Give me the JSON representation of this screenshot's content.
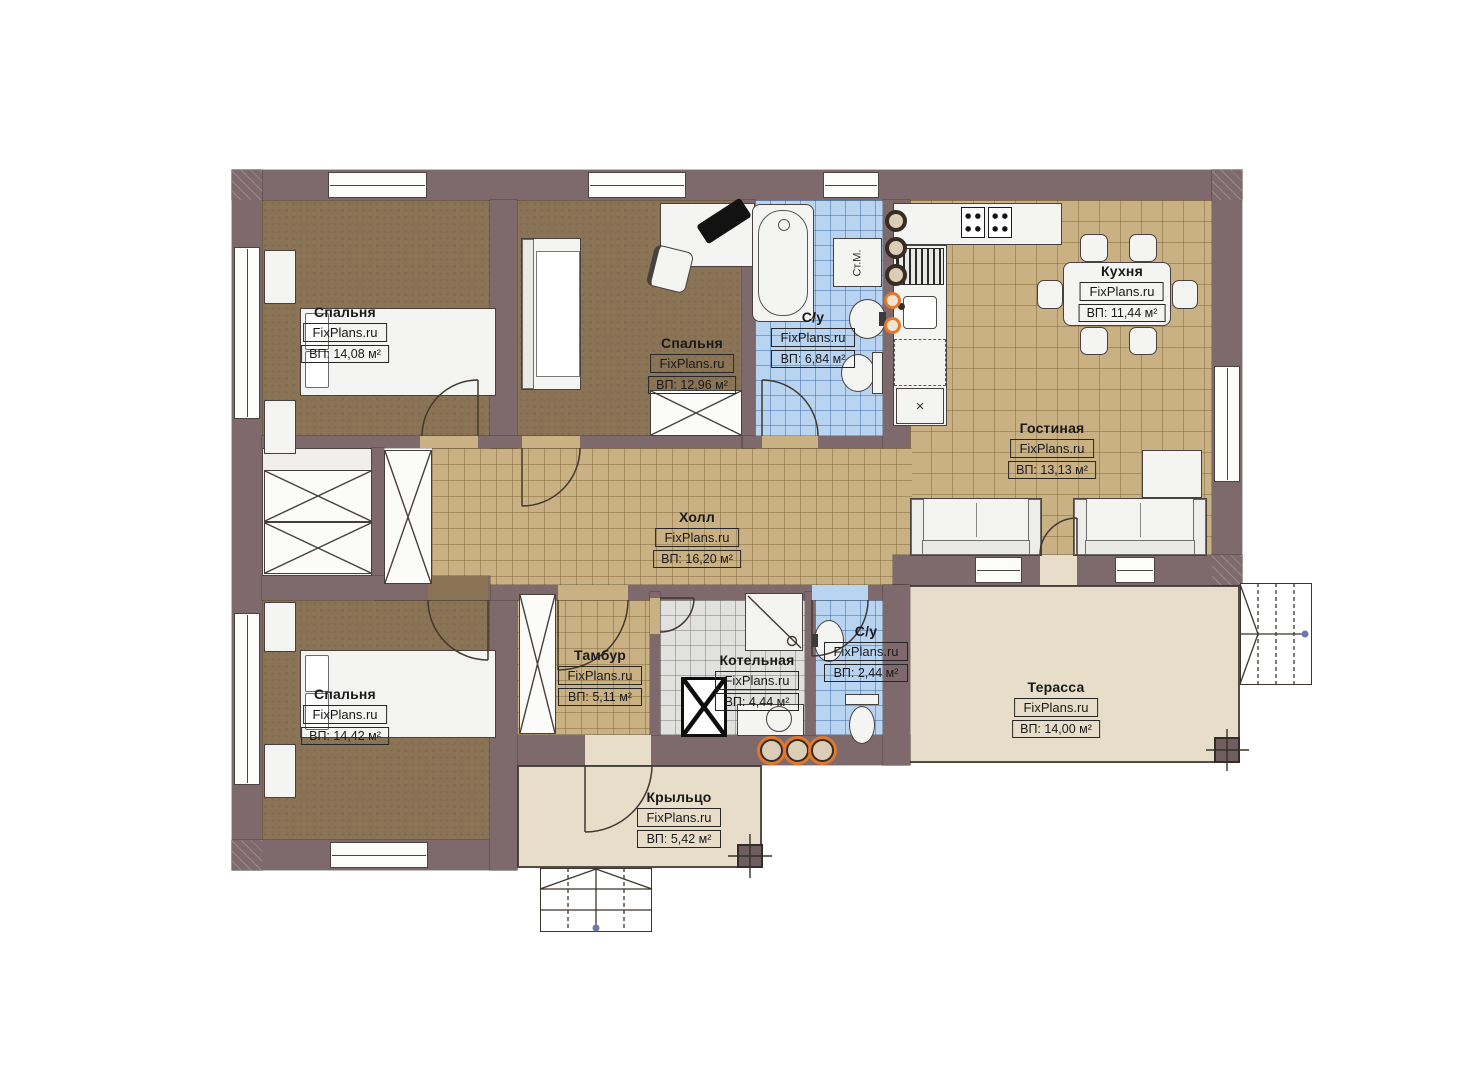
{
  "brand": "FixPlans.ru",
  "plan": {
    "rooms": [
      {
        "key": "bedroom-1",
        "name": "Спальня",
        "area": "ВП: 14,08 м²"
      },
      {
        "key": "bedroom-2",
        "name": "Спальня",
        "area": "ВП: 12,96 м²"
      },
      {
        "key": "bathroom-1",
        "name": "С/у",
        "area": "ВП: 6,84 м²"
      },
      {
        "key": "kitchen",
        "name": "Кухня",
        "area": "ВП: 11,44 м²"
      },
      {
        "key": "living-room",
        "name": "Гостиная",
        "area": "ВП: 13,13 м²"
      },
      {
        "key": "hall",
        "name": "Холл",
        "area": "ВП: 16,20 м²"
      },
      {
        "key": "bedroom-3",
        "name": "Спальня",
        "area": "ВП: 14,42 м²"
      },
      {
        "key": "vestibule",
        "name": "Тамбур",
        "area": "ВП: 5,11 м²"
      },
      {
        "key": "boiler-room",
        "name": "Котельная",
        "area": "ВП: 4,44 м²"
      },
      {
        "key": "bathroom-2",
        "name": "С/у",
        "area": "ВП: 2,44 м²"
      },
      {
        "key": "terrace",
        "name": "Терасса",
        "area": "ВП: 14,00 м²"
      },
      {
        "key": "porch",
        "name": "Крыльцо",
        "area": "ВП: 5,42 м²"
      }
    ],
    "annotations": {
      "washing_machine": "Ст.М."
    },
    "colors": {
      "wall": "#7e6a6c",
      "bedroom_floor": "#8b7356",
      "tile_tan": "#c9b184",
      "tile_blue": "#b9d4f1",
      "tile_gray": "#e1e1df",
      "outdoor": "#e7ddc9",
      "accent_orange": "#e2782a"
    }
  }
}
